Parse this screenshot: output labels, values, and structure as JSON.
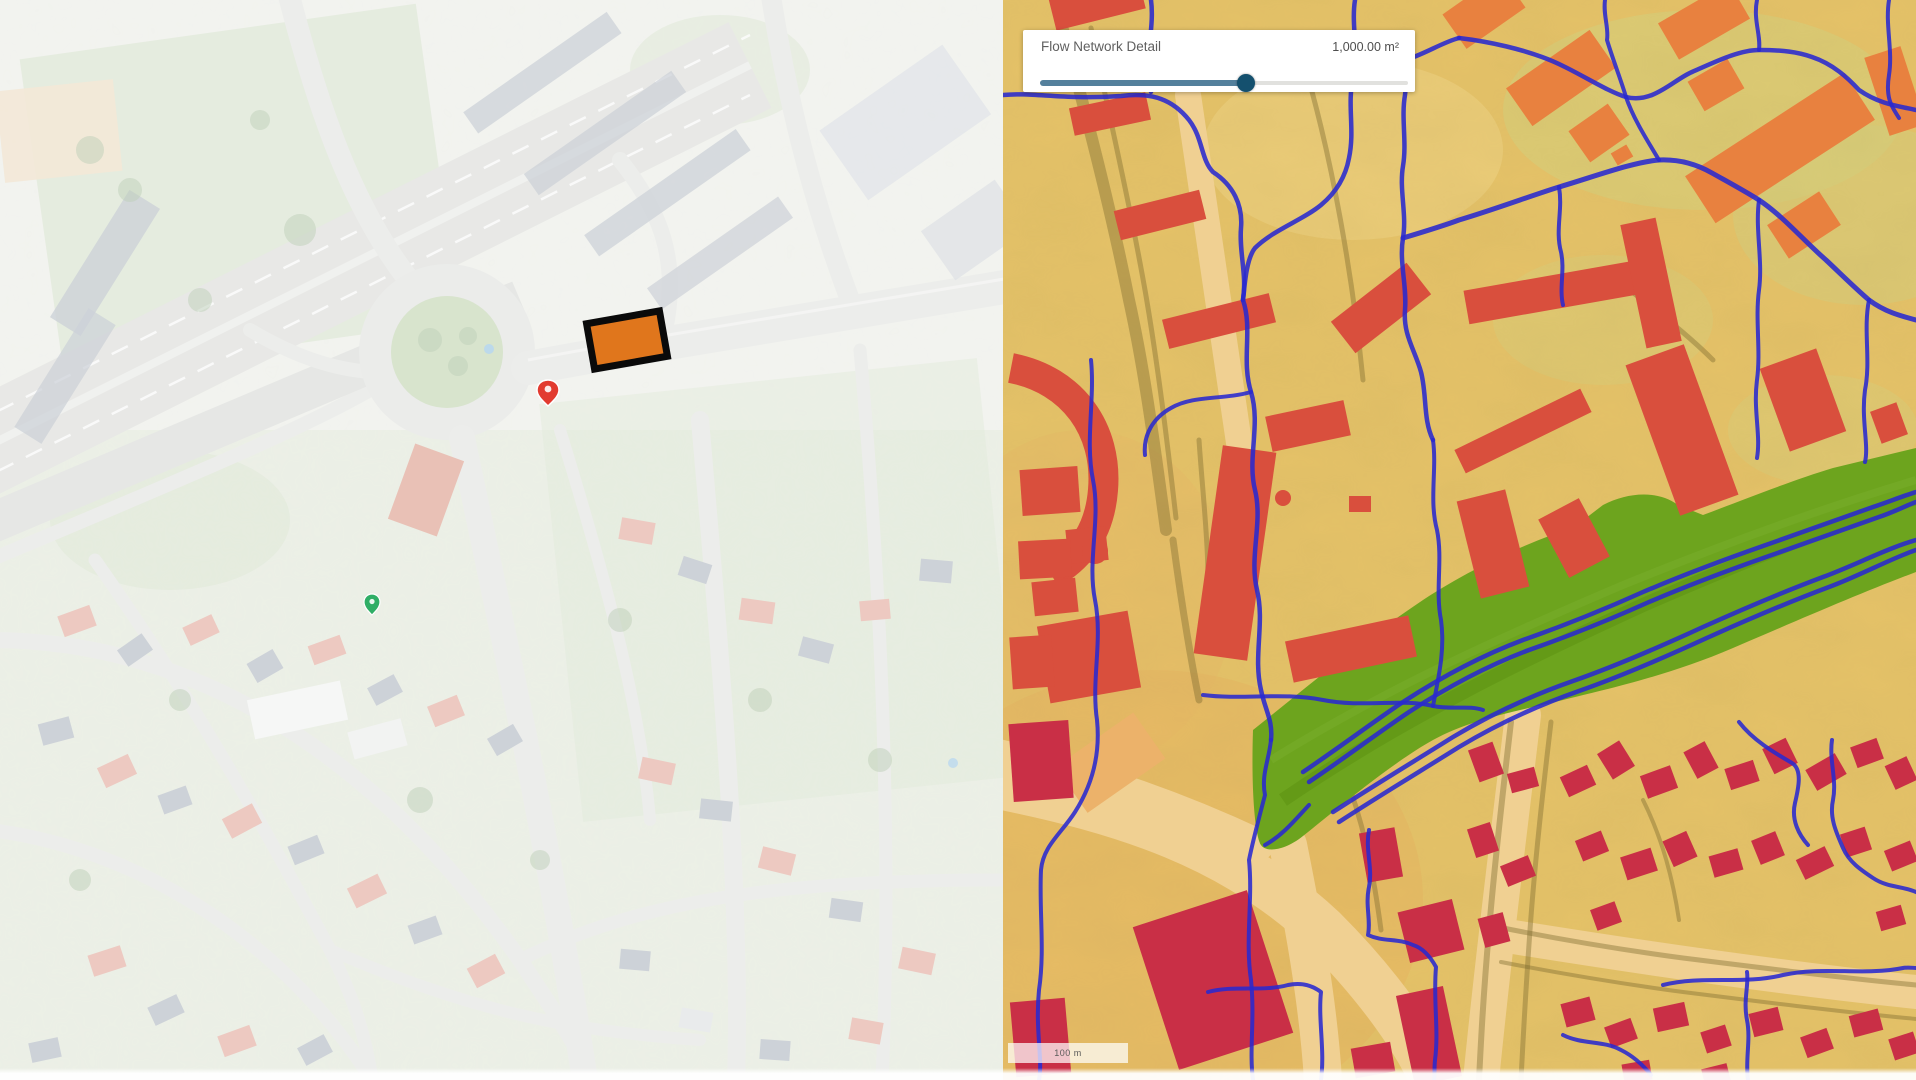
{
  "panel": {
    "label": "Flow Network Detail",
    "value": "1,000.00 m²",
    "slider_percent": 56
  },
  "scalebar": {
    "label": "100 m"
  },
  "left_map": {
    "kind": "aerial photo (faded)",
    "highlight_marker": {
      "shape": "rectangle",
      "fill": "#e0761c",
      "border": "#0a0a0a"
    },
    "red_pin_color": "#e23b30",
    "green_pin_color": "#2fae66"
  },
  "right_map": {
    "kind": "terrain flow analysis",
    "colors": {
      "terrain_sand": "#e5c268",
      "terrain_green_tint": "#d6ce7b",
      "road_tan": "#f0d092",
      "flow_line_blue": "#2929cf",
      "green_corridor": "#6da41e",
      "building_red": "#d94f3d",
      "building_crimson": "#c92f46",
      "building_orange": "#e8813f"
    }
  },
  "ui_colors": {
    "slider_fill": "#54809c",
    "slider_thumb": "#14506e",
    "panel_background": "#ffffff"
  }
}
